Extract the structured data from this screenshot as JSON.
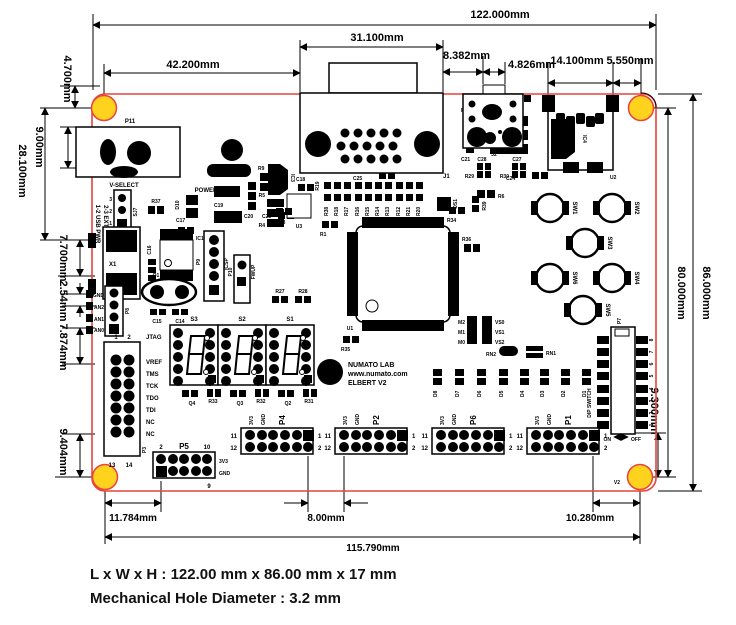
{
  "footer": {
    "line1": "L x W x H : 122.00 mm x 86.00 mm x 17 mm",
    "line2": "Mechanical Hole Diameter : 3.2 mm"
  },
  "colors": {
    "outline": "#E8433C",
    "hole": "#FFD21E"
  },
  "dims": {
    "board_width": "122.000mm",
    "vga_width": "31.100mm",
    "left_to_vga": "42.200mm",
    "vga_to_jack": "8.382mm",
    "jack_width": "4.826mm",
    "sd_width": "14.100mm",
    "sd_to_hole": "5.550mm",
    "hole_offset_top": "4.700mm",
    "dc_jack": "9.00mm",
    "top_to_usb": "28.100mm",
    "usb_span": "7.700mm",
    "pin_pitch": "2.54mm",
    "an_to_jtag": "7.874mm",
    "jtag_to_hole": "9.404mm",
    "board_height": "86.000mm",
    "hole_span_v": "80.000mm",
    "dip_to_hole": "9.300mm",
    "hole_to_p5": "11.784mm",
    "p4_to_p2": "8.00mm",
    "p1_to_hole": "10.280mm",
    "hole_span_h": "115.790mm"
  },
  "logo": {
    "mark": "S",
    "brand": "NUMATO LAB",
    "site": "www.numato.com",
    "product": "ELBERT V2"
  },
  "refs": {
    "p11": "P11",
    "r8": "R8",
    "r11": "R11",
    "c22": "C22",
    "c25": "C25",
    "ic5": "IC5",
    "r7": "R7",
    "r10": "R10",
    "c21": "C21",
    "c24": "C24",
    "ic4": "IC4",
    "r6": "R6",
    "r9": "R9",
    "c19": "C19",
    "c20": "C20",
    "c23": "C23",
    "c17": "C17",
    "ic3": "IC3",
    "j1": "J1",
    "j2": "J2",
    "c28": "C28",
    "c27": "C27",
    "r29": "R29",
    "r30": "R30",
    "u2": "U2",
    "vselect": "V-SELECT",
    "usbpwr": "1-2 USB PWR",
    "extpwr": "2-3 EXT PWR",
    "sj7": "SJ7",
    "power": "POWER",
    "r37": "R37",
    "d10": "D10",
    "x1": "X1",
    "c16": "C16",
    "ic1": "IC1",
    "p9": "P9",
    "icsp": "ICSP",
    "p10": "P10",
    "fwup": "FWUP",
    "q1": "Q1",
    "c15": "C15",
    "c14": "C14",
    "gnd": "GND",
    "an2": "AN2",
    "an1": "AN1",
    "an0": "AN0",
    "p8": "P8",
    "jtag": "JTAG",
    "vref": "VREF",
    "tms": "TMS",
    "tck": "TCK",
    "tdo": "TDO",
    "tdi": "TDI",
    "nc": "NC",
    "p3": "P3",
    "c18": "C18",
    "r5": "R5",
    "r4": "R4",
    "u3": "U3",
    "r19": "R19",
    "r3": "R3",
    "r1": "R1",
    "u1": "U1",
    "os1": "OS1",
    "r34": "R34",
    "r39": "R39",
    "r36": "R36",
    "m2": "M2",
    "m1": "M1",
    "m0": "M0",
    "vs0": "VS0",
    "vs1": "VS1",
    "vs2": "VS2",
    "rn2": "RN2",
    "rn1": "RN1",
    "r35": "R35",
    "r27": "R27",
    "r28": "R28",
    "s3": "S3",
    "s2": "S2",
    "s1": "S1",
    "q4": "Q4",
    "r33": "R33",
    "q3": "Q3",
    "r32": "R32",
    "q2": "Q2",
    "r31": "R31",
    "sw1": "SW1",
    "sw2": "SW2",
    "sw3": "SW3",
    "sw4": "SW4",
    "sw5": "SW5",
    "sw6": "SW6",
    "p7": "P7",
    "dipswitch": "DIP SWITCH",
    "on": "ON",
    "off": "OFF",
    "p5": "P5",
    "p4": "P4",
    "p2": "P2",
    "p6": "P6",
    "p1": "P1",
    "v2": "V2"
  },
  "pins": {
    "n1": "1",
    "n2": "2",
    "n3": "3",
    "n9": "9",
    "n10": "10",
    "n11": "11",
    "n12": "12",
    "n13": "13",
    "n14": "14",
    "v33": "3V3",
    "gnd": "GND"
  },
  "resistor_row": [
    "R38",
    "R18",
    "R17",
    "R16",
    "R15",
    "R14",
    "R13",
    "R12",
    "R21",
    "R20"
  ],
  "led_row": [
    "D8",
    "D7",
    "D6",
    "D5",
    "D4",
    "D3",
    "D2",
    "D1"
  ],
  "dip_numbers": [
    "8",
    "7",
    "6",
    "5",
    "4",
    "3",
    "2",
    "1"
  ]
}
